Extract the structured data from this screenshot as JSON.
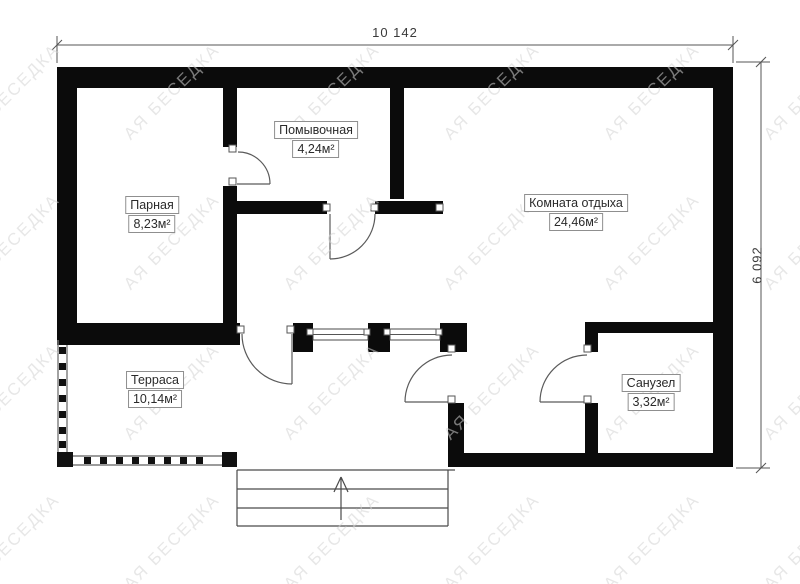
{
  "drawing": {
    "type": "bath-house floor plan",
    "stairs_direction": "up-arrow"
  },
  "dimensions": {
    "width": "10 142",
    "height": "6 092"
  },
  "rooms": [
    {
      "name": "Парная",
      "area": "8,23м²"
    },
    {
      "name": "Помывочная",
      "area": "4,24м²"
    },
    {
      "name": "Комната отдыха",
      "area": "24,46м²"
    },
    {
      "name": "Терраса",
      "area": "10,14м²"
    },
    {
      "name": "Санузел",
      "area": "3,32м²"
    }
  ],
  "watermark": {
    "text": "АЯ БЕСЕДКА"
  },
  "colors": {
    "wall": "#0b0b0b",
    "line": "#555555",
    "label_border": "#8f8f8f",
    "background": "#ffffff",
    "watermark": "#d4d4d4"
  }
}
